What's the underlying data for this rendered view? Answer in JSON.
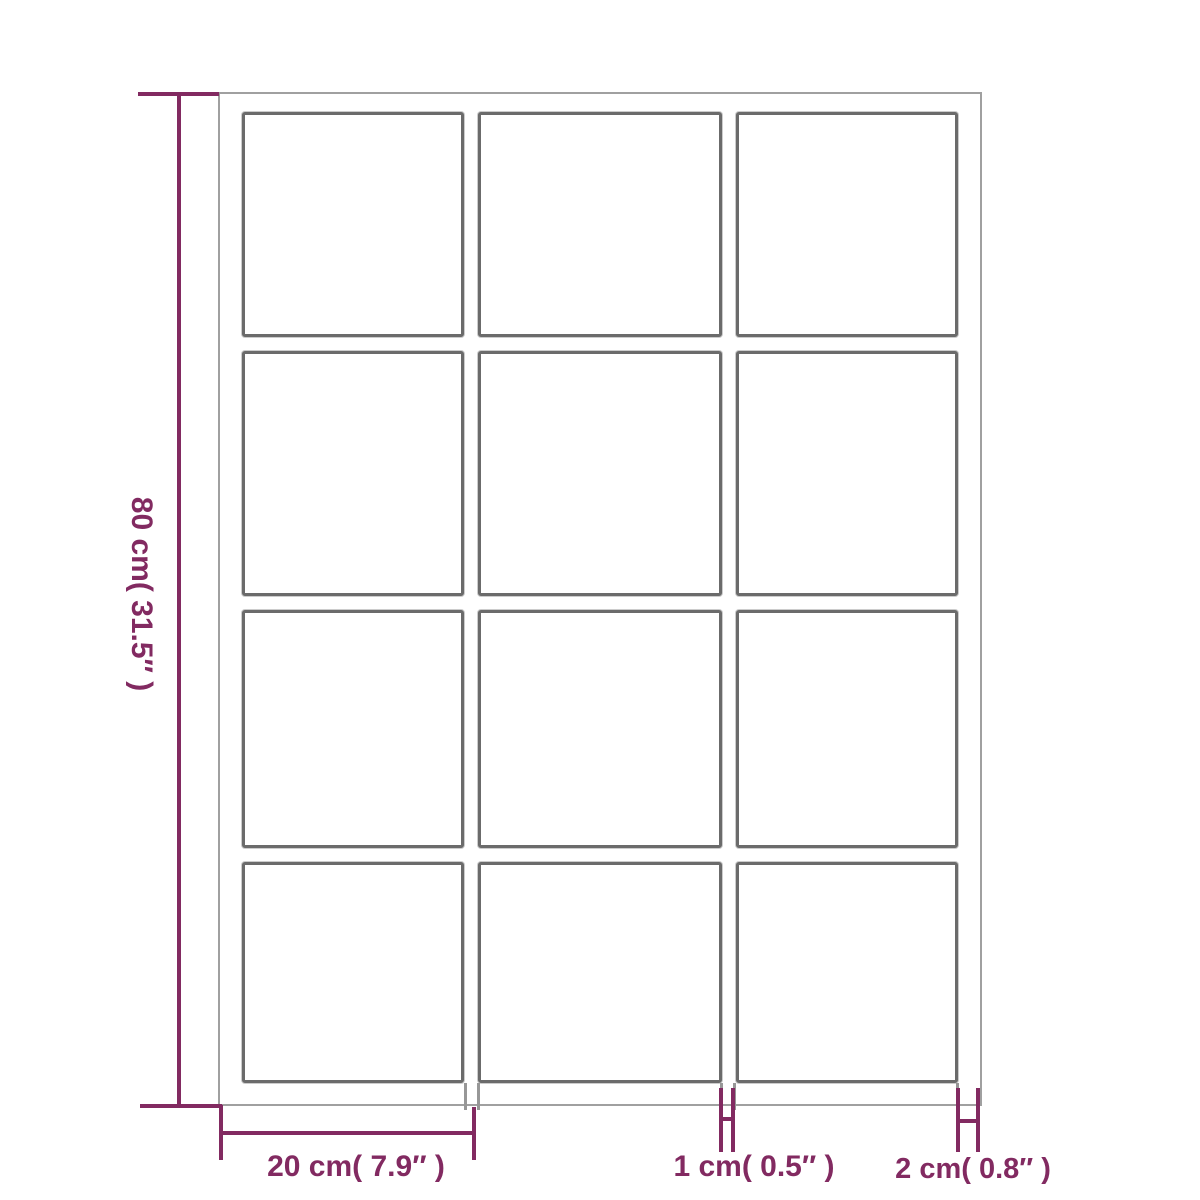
{
  "mirror": {
    "grid_columns": 3,
    "grid_rows": 4,
    "pane_count": 12
  },
  "colors": {
    "dimension_purple": "#822a61",
    "outer_frame_gray": "#a0a0a0",
    "pane_border_gray": "#6b6b6b",
    "background": "#ffffff"
  },
  "dimensions": {
    "height": {
      "label": "80 cm( 31.5″ )"
    },
    "pane_width": {
      "label": "20 cm( 7.9″ )"
    },
    "divider_width": {
      "label": "1 cm( 0.5″ )"
    },
    "frame_thickness": {
      "label": "2 cm( 0.8″ )"
    }
  }
}
